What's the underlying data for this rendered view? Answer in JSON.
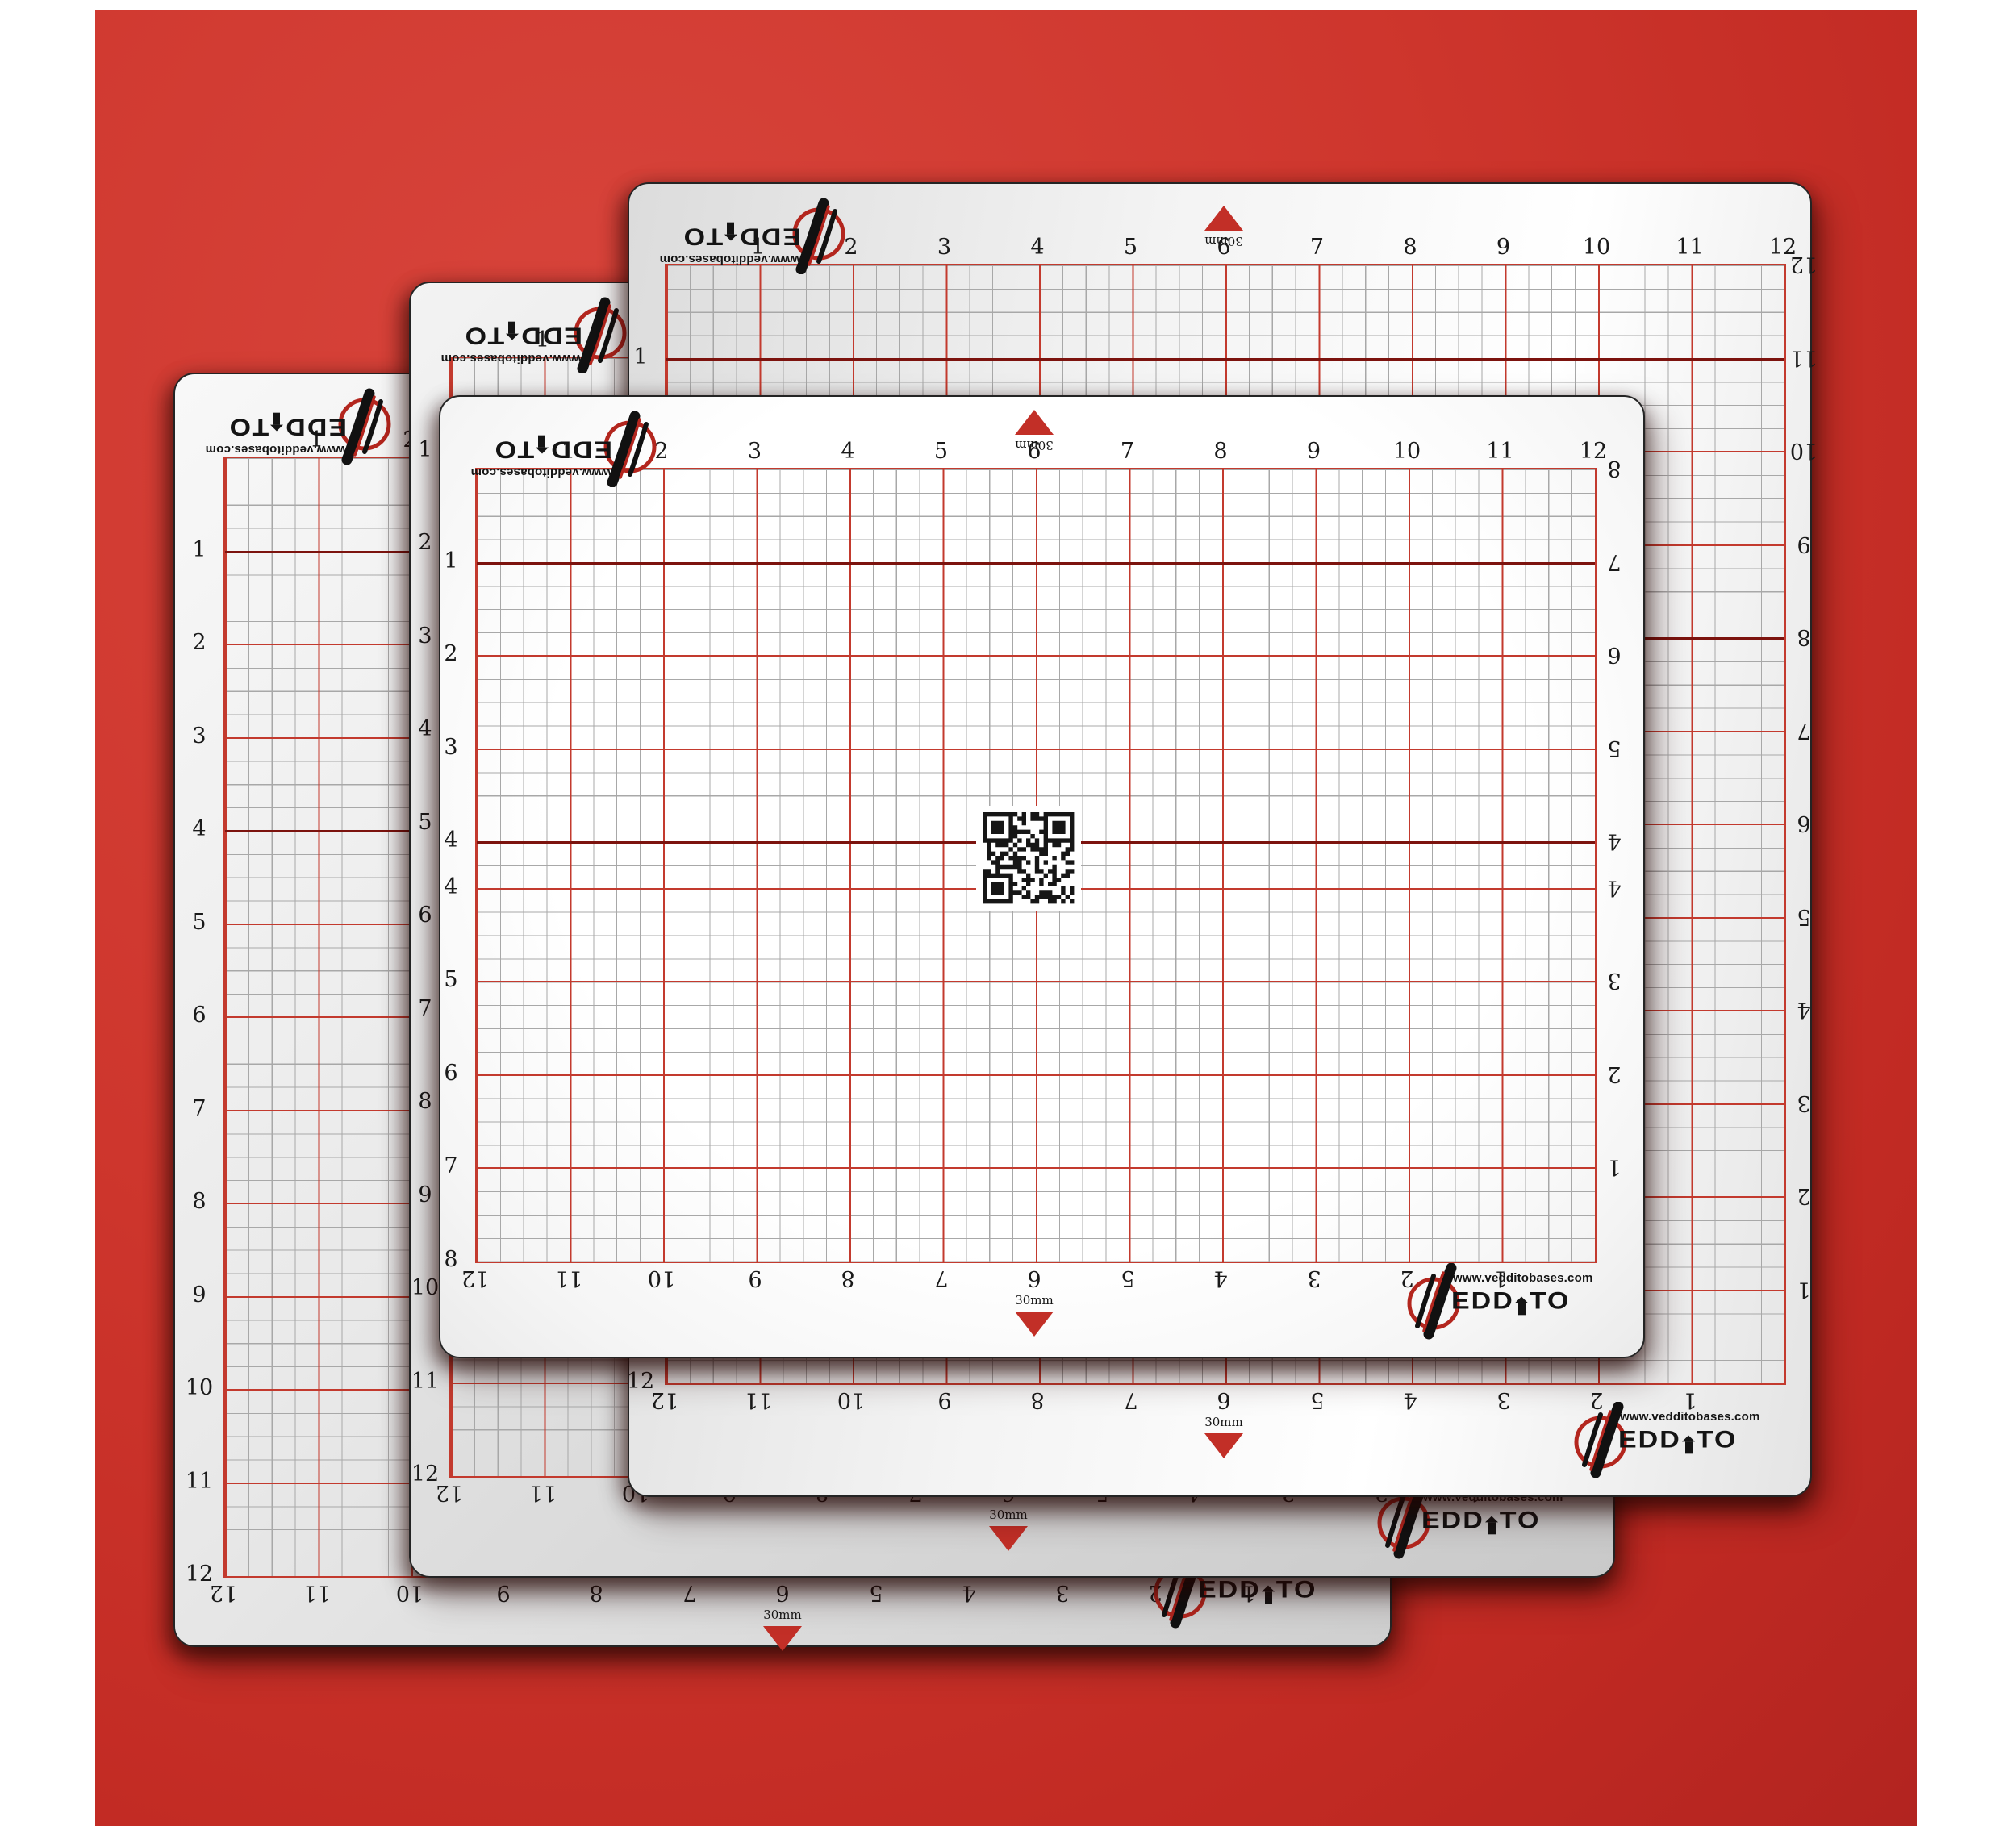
{
  "scene": {
    "kind": "product-image",
    "subject": "four overlapping self-healing cutting mats on a red backdrop"
  },
  "backdrop": {
    "color": "#cd352c"
  },
  "brand": {
    "wordmark_display": "EDDITO",
    "wordmark_reads": "VEDDITO",
    "url": "www.vedditobases.com",
    "logo_icon": "v-swoosh-in-red-circle"
  },
  "marker": {
    "arrow_label": "30mm"
  },
  "colors": {
    "line_minor": "#a8a8a8",
    "line_major": "#c33a2e",
    "line_dark": "#7c130e",
    "label_text": "#1a1a1a",
    "arrow_red": "#c22f27",
    "ring_red": "#b3261e"
  },
  "mats": [
    {
      "name": "cutting-mat-back-left",
      "top_labels": [
        "1",
        "2",
        "3",
        "4",
        "5",
        "6",
        "7",
        "8",
        "9",
        "10",
        "11",
        "12"
      ],
      "bottom_labels": [
        "12",
        "11",
        "10",
        "9",
        "8",
        "7",
        "6",
        "5",
        "4",
        "3",
        "2",
        "1"
      ],
      "left_labels": [
        "1",
        "2",
        "3",
        "4",
        "5",
        "6",
        "7",
        "8",
        "9",
        "10",
        "11",
        "12"
      ],
      "right_labels": [
        "12",
        "11",
        "10",
        "9",
        "8",
        "7",
        "6",
        "5",
        "4",
        "3",
        "2",
        "1"
      ],
      "has_qr": false
    },
    {
      "name": "cutting-mat-middle-left",
      "top_labels": [
        "1",
        "2",
        "3",
        "4",
        "5",
        "6",
        "7",
        "8",
        "9",
        "10",
        "11",
        "12"
      ],
      "bottom_labels": [
        "12",
        "11",
        "10",
        "9",
        "8",
        "7",
        "6",
        "5",
        "4",
        "3",
        "2",
        "1"
      ],
      "left_labels": [
        "1",
        "2",
        "3",
        "4",
        "5",
        "6",
        "7",
        "8",
        "9",
        "10",
        "11",
        "12"
      ],
      "right_labels": [
        "12",
        "11",
        "10",
        "9",
        "8",
        "7",
        "6",
        "5",
        "4",
        "3",
        "2",
        "1"
      ],
      "has_qr": false
    },
    {
      "name": "cutting-mat-back-right",
      "top_labels": [
        "1",
        "2",
        "3",
        "4",
        "5",
        "6",
        "7",
        "8",
        "9",
        "10",
        "11",
        "12"
      ],
      "bottom_labels": [
        "12",
        "11",
        "10",
        "9",
        "8",
        "7",
        "6",
        "5",
        "4",
        "3",
        "2",
        "1"
      ],
      "left_labels": [
        "1",
        "2",
        "3",
        "4",
        "5",
        "6",
        "7",
        "8",
        "9",
        "10",
        "11",
        "12"
      ],
      "right_labels": [
        "12",
        "11",
        "10",
        "9",
        "8",
        "7",
        "6",
        "5",
        "4",
        "3",
        "2",
        "1"
      ],
      "has_qr": false
    },
    {
      "name": "cutting-mat-front",
      "top_labels": [
        "1",
        "2",
        "3",
        "4",
        "5",
        "6",
        "7",
        "8",
        "9",
        "10",
        "11",
        "12"
      ],
      "bottom_labels": [
        "12",
        "11",
        "10",
        "9",
        "8",
        "7",
        "6",
        "5",
        "4",
        "3",
        "2",
        "1"
      ],
      "left_labels": [
        "1",
        "2",
        "3",
        "4",
        "4",
        "5",
        "6",
        "7",
        "8"
      ],
      "right_labels": [
        "8",
        "7",
        "6",
        "5",
        "4",
        "4",
        "3",
        "2",
        "1"
      ],
      "has_qr": true
    }
  ]
}
